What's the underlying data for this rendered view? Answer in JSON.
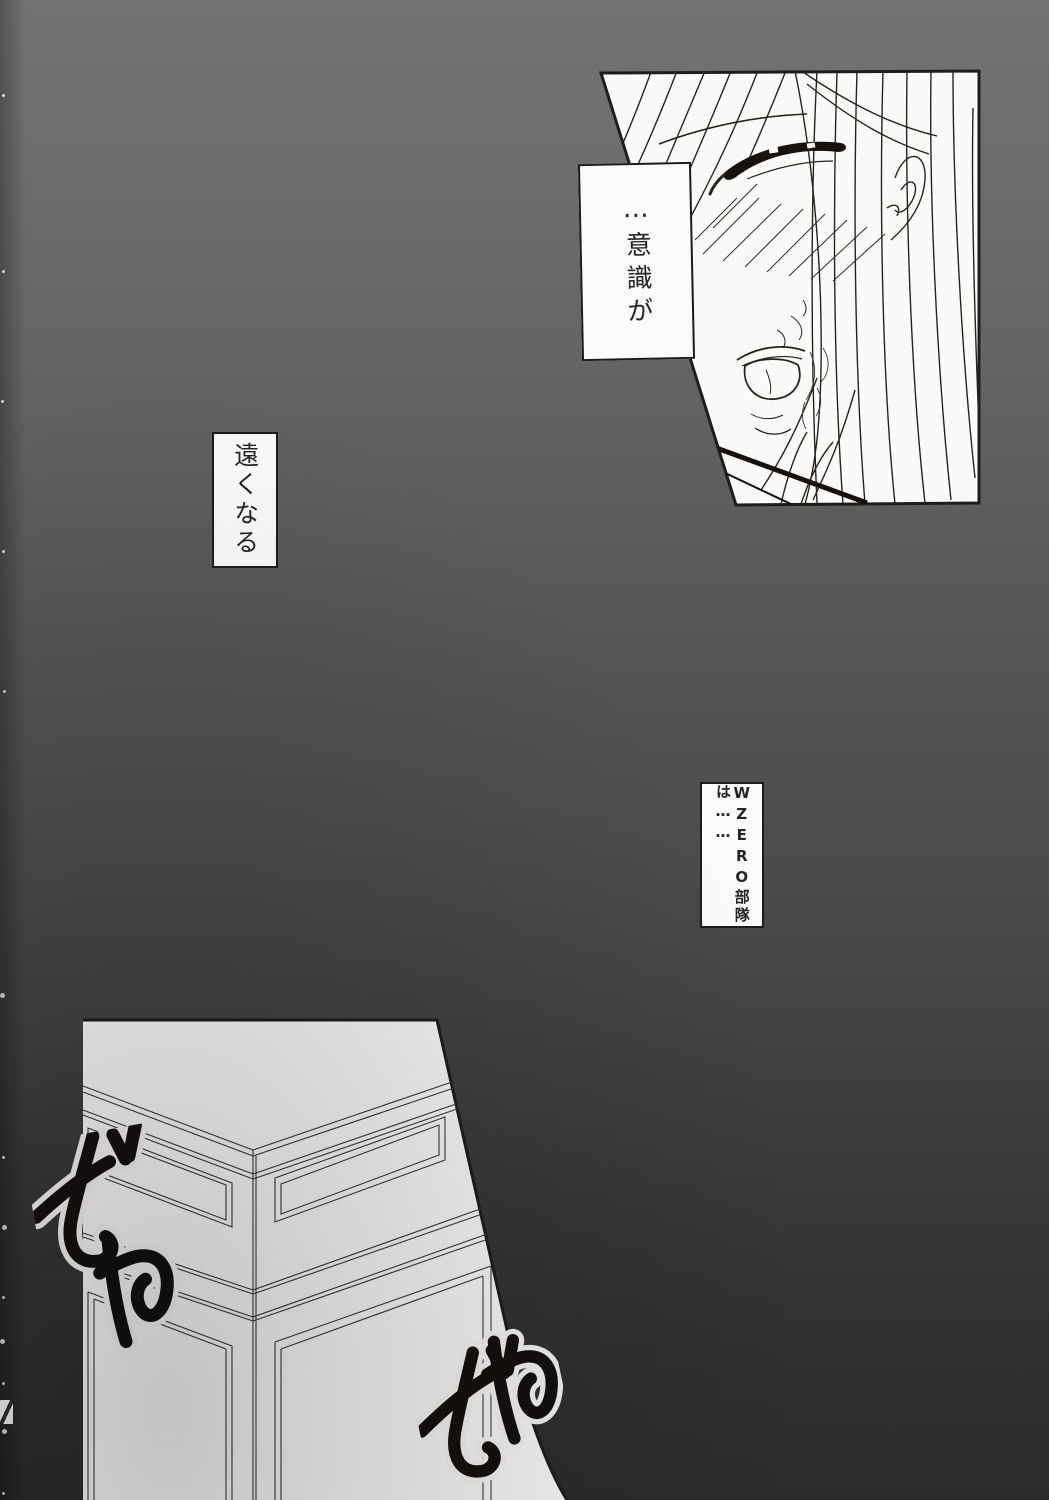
{
  "page": {
    "kind": "manga-page",
    "colors": {
      "background_top": "#757371",
      "background_bottom": "#2e2c2b",
      "panel_fill": "#fbfaf8",
      "ink": "#1c1a18"
    }
  },
  "speech": {
    "consciousness": "…意識が",
    "fading": "遠くなる",
    "wzero": "WZERO部隊は……"
  },
  "sfx": {
    "left": "ざわ",
    "bottom": "ざわ"
  }
}
